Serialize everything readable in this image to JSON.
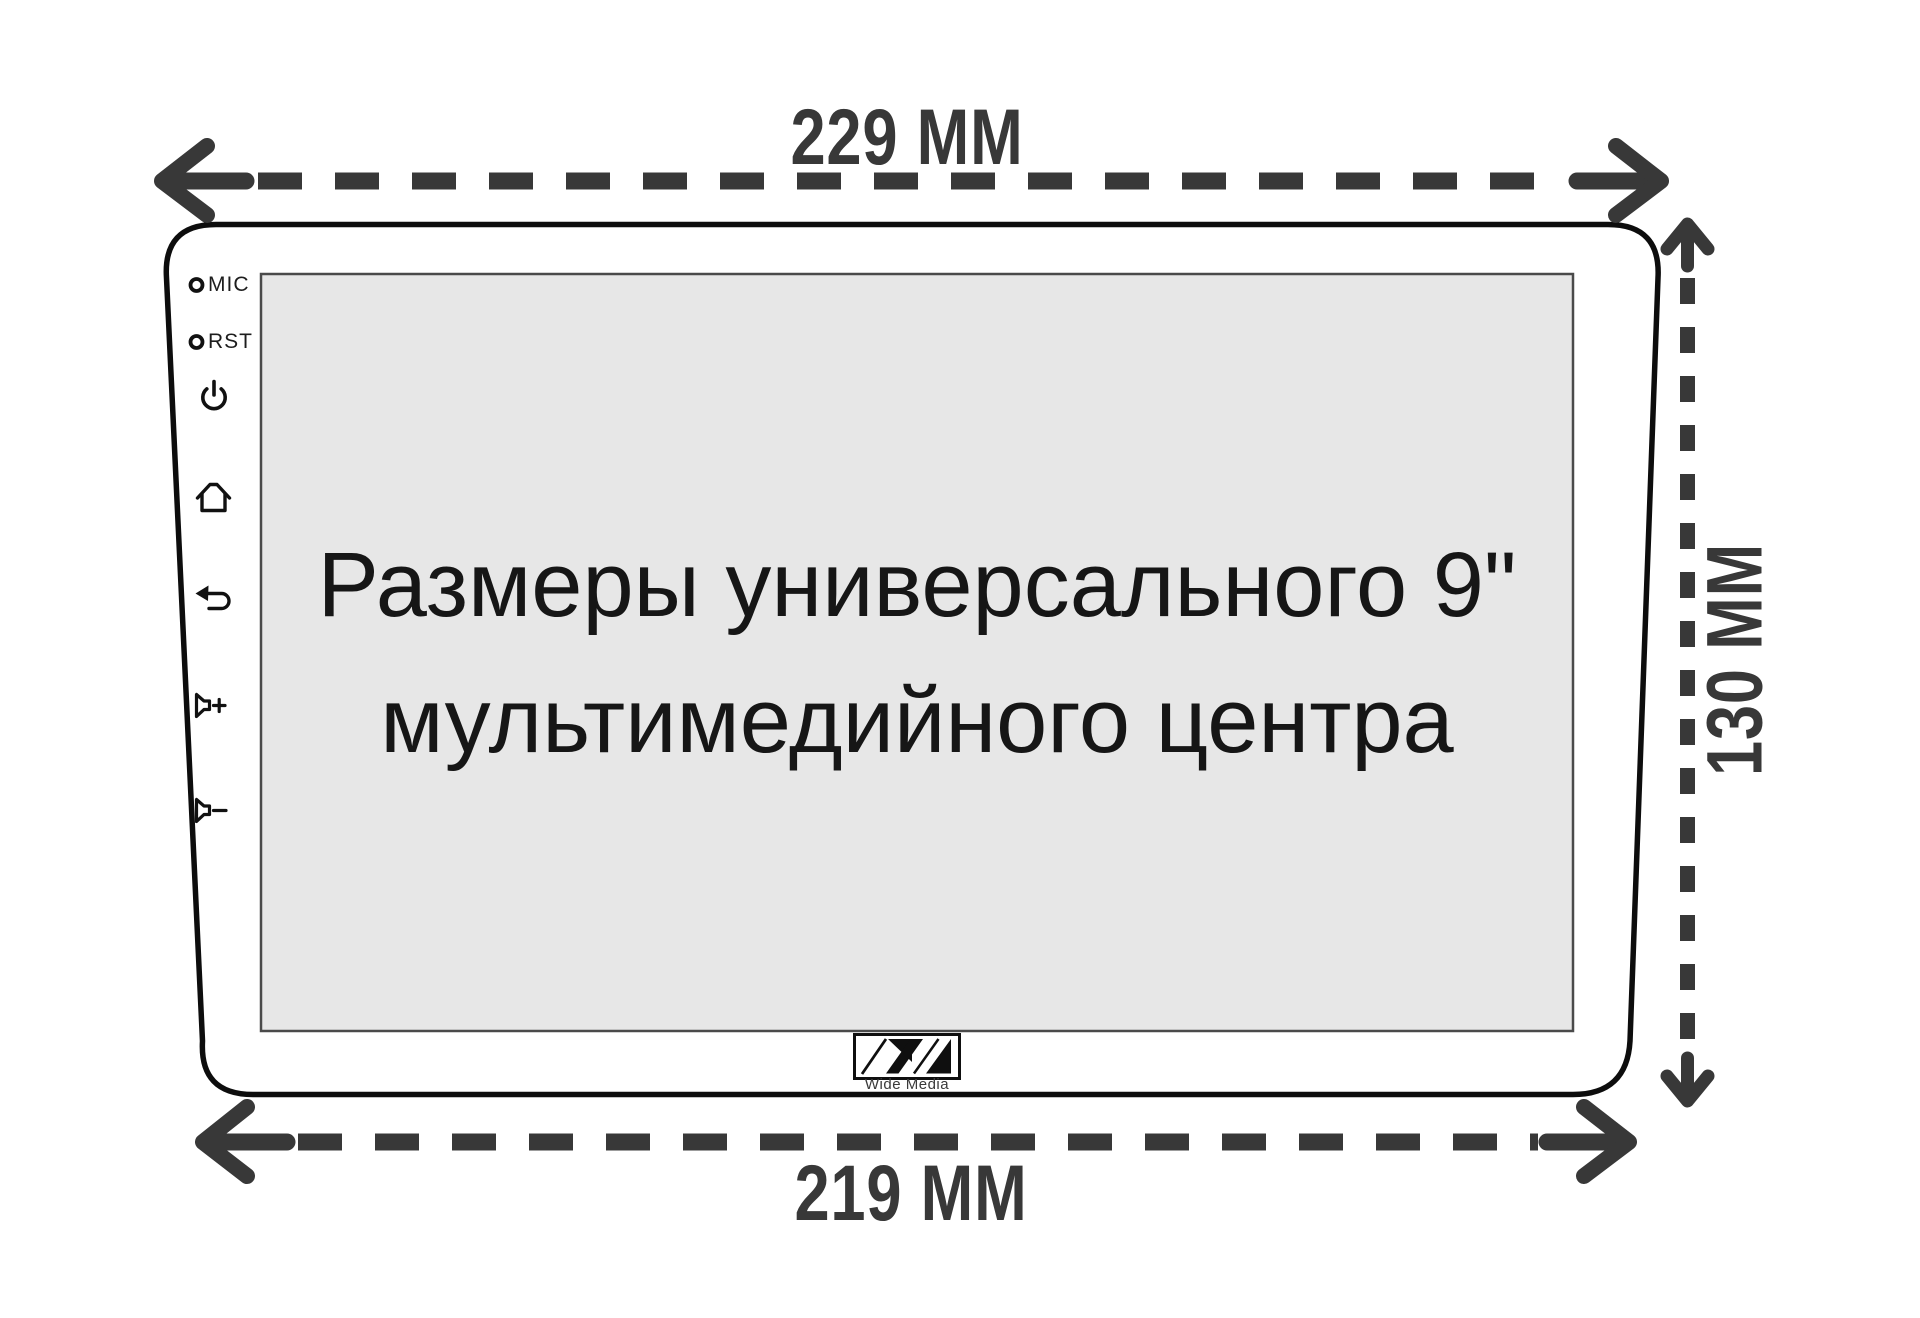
{
  "diagram": {
    "type": "product-dimension-diagram",
    "subject": "universal 9-inch car multimedia head unit",
    "colors": {
      "background": "#ffffff",
      "arrow": "#383838",
      "device_outline": "#0d0d0d",
      "screen_background": "#e7e7e7",
      "screen_border": "#4a4a4a",
      "screen_text": "#161616"
    },
    "dimensions": {
      "top_width_label": "229 MM",
      "bottom_width_label": "219 MM",
      "height_label": "130 MM"
    },
    "screen": {
      "line1": "Размеры универсального 9\"",
      "line2": "мультимедийного центра"
    },
    "bezel_controls": {
      "mic_label": "MIC",
      "rst_label": "RST",
      "icons": [
        "power-icon",
        "home-icon",
        "back-icon",
        "volume-up-icon",
        "volume-down-icon"
      ]
    },
    "logo": {
      "text": "Wide Media"
    }
  }
}
